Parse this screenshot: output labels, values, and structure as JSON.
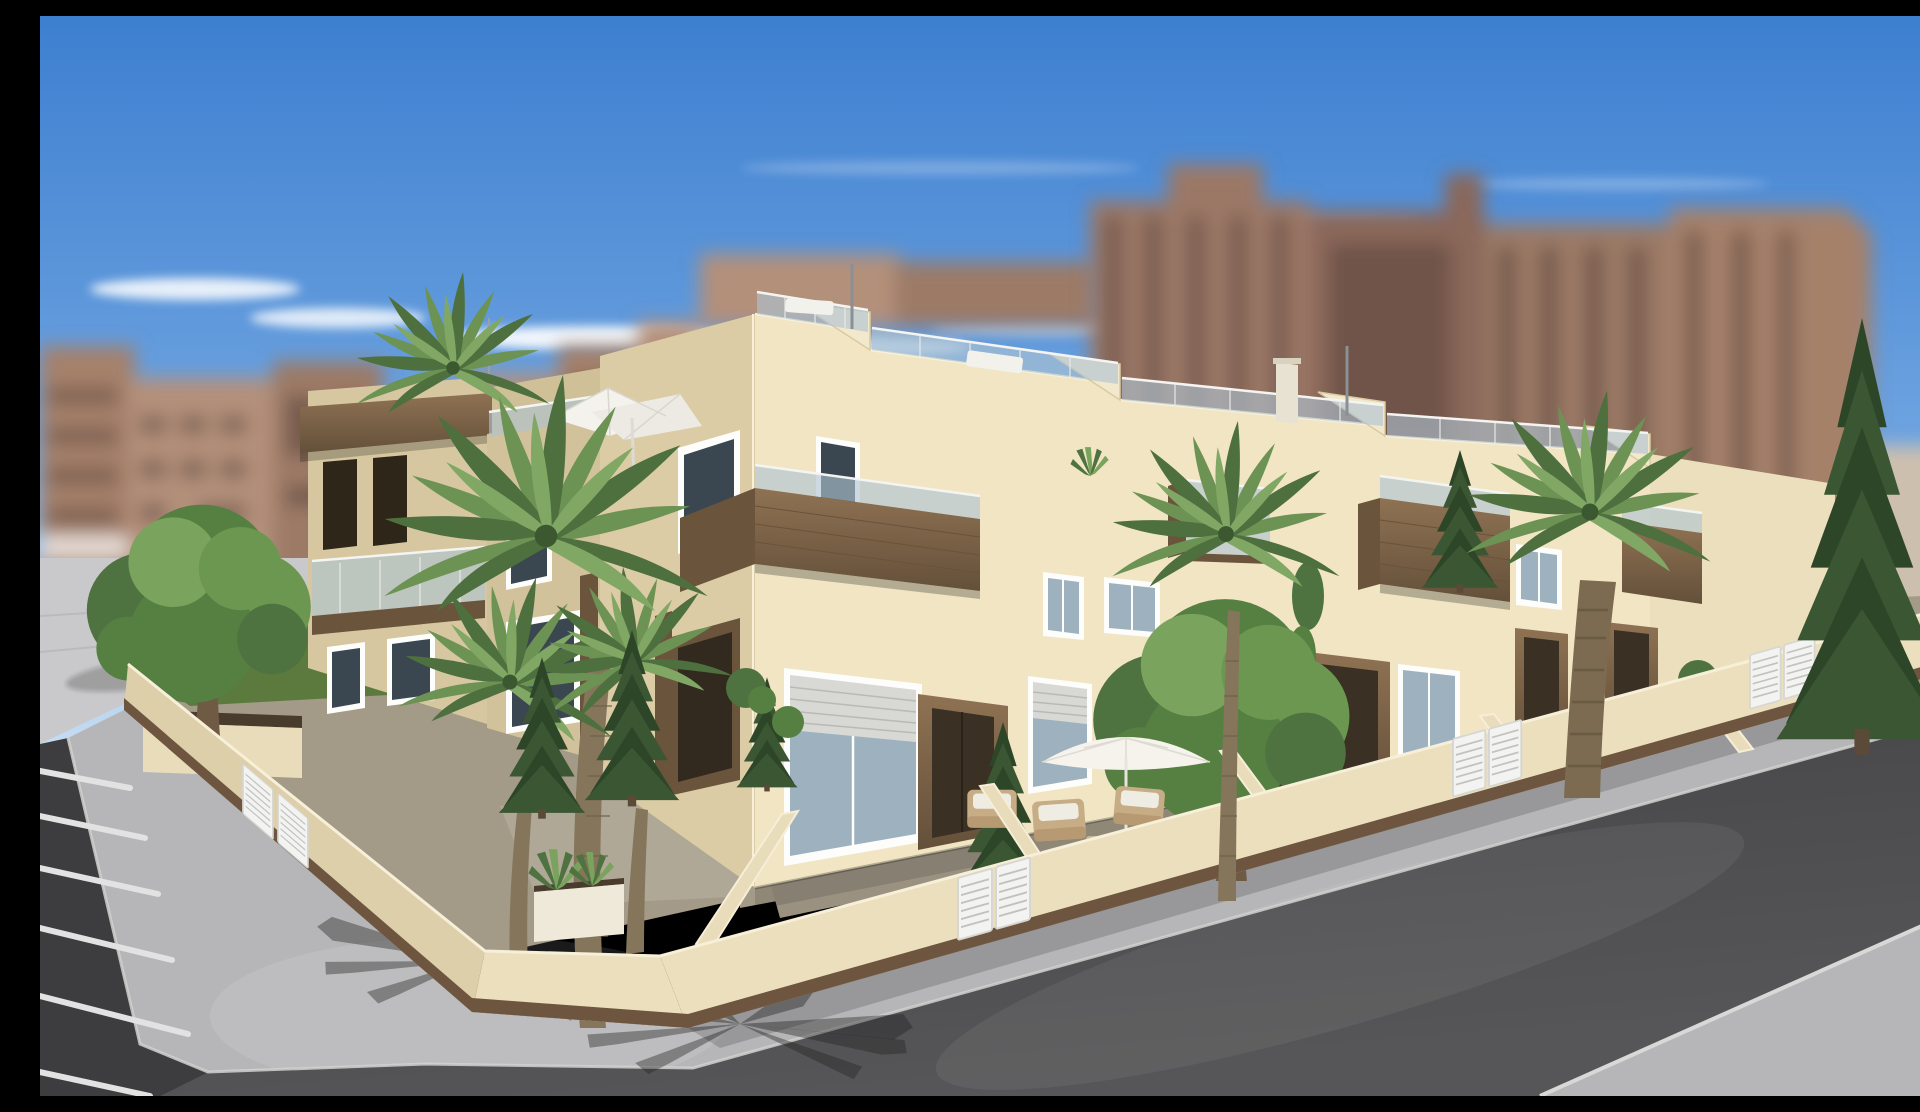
{
  "scene": {
    "description": "Sunny photorealistic exterior render of a cream two-storey corner townhouse development with rooftop terraces, viewed from the street corner",
    "sky": "clear blue sky with thin white clouds above the skyline",
    "background": {
      "left": "blurred tan mid-rise apartment blocks",
      "right": "blurred brown high-rise apartment towers",
      "far_left_detail": "white railing sliver"
    },
    "townhouses": {
      "storeys": 2,
      "rooftop": [
        "roof terraces with glass balustrades",
        "sloped party walls",
        "white parasol",
        "rooftop palm",
        "agave pot",
        "white loungers",
        "vent poles",
        "chimney"
      ],
      "facade": [
        "cream stucco",
        "timber-clad balcony boxes with glass rails",
        "white framed windows",
        "roller shutters",
        "dark timber entrance surrounds",
        "recessed doors"
      ],
      "left_facade": [
        "corner tower with timber lintel and two pergola openings",
        "glass balcony band",
        "shaded cream finish"
      ]
    },
    "garden": [
      "cream perimeter wall with timber plinth",
      "white slatted garden gates",
      "front patios",
      "white patio parasol",
      "wicker armchairs",
      "planter boxes",
      "agaves",
      "lavender planter"
    ],
    "vegetation": [
      "tall foreground palms",
      "street date palms",
      "cypress trees",
      "round leafy trees",
      "clipped shrubs",
      "lawn strips"
    ],
    "streets": {
      "left": "dark asphalt with white parking bay markings",
      "corner": "chamfered light concrete pavement with palm frond shadows",
      "right": "asphalt road with pavement on both sides",
      "far_left": "light concrete plaza"
    }
  },
  "palette": {
    "sky_top": "#3d7fd0",
    "sky_mid": "#6da3e0",
    "sky_horizon": "#cfe3f4",
    "cloud": "#ffffff",
    "bg_tan": "#b3907a",
    "bg_brown": "#9b7866",
    "bg_window": "#5e463e",
    "facade_front": "#f1e5c4",
    "facade_side": "#d6c7a1",
    "facade_side_light": "#dbcca6",
    "wood_accent": "#8a6c4f",
    "wood_dark": "#6b543c",
    "glass": "#aec3d2",
    "window_dark": "#3a4750",
    "frame_white": "#fdfdfb",
    "wall_cream": "#ebdfbd",
    "wall_shade": "#dccfa9",
    "wall_plinth": "#6d5540",
    "gate_white": "#f3f3f1",
    "pavement": "#b6b6b8",
    "plaza": "#c9c9cb",
    "asphalt_left": "#3d3d3f",
    "asphalt_right": "#4b4b4d",
    "marking_white": "#e2e2e2",
    "lawn": "#5c7a3e",
    "palm_dark": "#4e6f3e",
    "palm_mid": "#6d9354",
    "palm_light": "#81a765",
    "conifer": "#3a5632",
    "tree_green": "#567f42",
    "trunk": "#85755a",
    "soil": "#4a3c2c"
  }
}
